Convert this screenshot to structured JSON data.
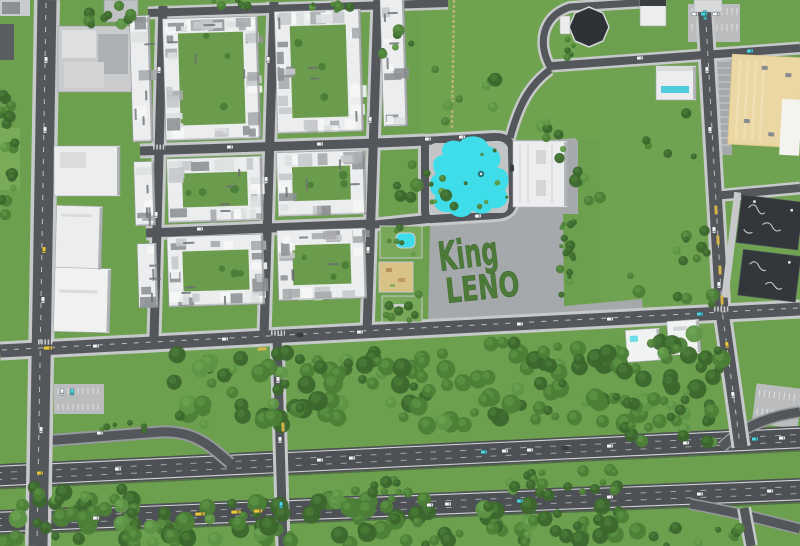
{
  "scene": {
    "description": "Top-down aerial view of a city district: residential apartment blocks, a cyan lagoon pool park, a concrete plaza with 'King LENO' written in hedges, green fields with tree belts, and a twin-carriageway highway with ramps along the bottom."
  },
  "plaza_sign": {
    "line1": "King",
    "line2": "LENO"
  },
  "palette": {
    "grass": "#6CA04E",
    "grass_light": "#7BAD5B",
    "tree_dark": "#3C672D",
    "tree_mid": "#4C7F37",
    "tree_light": "#5E9546",
    "asphalt": "#53565A",
    "highway": "#4D5054",
    "sidewalk": "#C6C8CA",
    "plaza": "#A6A9AC",
    "concrete_light": "#BABCBE",
    "pool": "#3EDDE9",
    "deck": "#C2C4C5",
    "white_bld": "#ECEDEE",
    "roof_gray": "#C9CBCC",
    "bld_shadow": "#7E8184",
    "beige": "#EBD7A4",
    "charcoal": "#33373B",
    "sand": "#D9C286",
    "hedge": "#4C7A38",
    "lane": "#E9EAEB",
    "dirt": "#C9B77A",
    "car_white": "#F4F5F6",
    "car_yellow": "#E9C83D",
    "car_cyan": "#4AD7E3",
    "car_dark": "#3A3E42",
    "park_green": "#79A85A"
  },
  "residential": {
    "blocks": [
      {
        "x": 167,
        "y": 16,
        "w": 95,
        "h": 122,
        "cy": true
      },
      {
        "x": 279,
        "y": 12,
        "w": 86,
        "h": 122,
        "cy": true
      },
      {
        "x": 385,
        "y": 2,
        "w": 24,
        "h": 128,
        "cy": false
      },
      {
        "x": 134,
        "y": 12,
        "w": 20,
        "h": 126,
        "cy": false
      },
      {
        "x": 167,
        "y": 156,
        "w": 95,
        "h": 64,
        "cy": true
      },
      {
        "x": 277,
        "y": 153,
        "w": 88,
        "h": 64,
        "cy": true
      },
      {
        "x": 134,
        "y": 158,
        "w": 20,
        "h": 64,
        "cy": false
      },
      {
        "x": 165,
        "y": 234,
        "w": 96,
        "h": 70,
        "cy": true
      },
      {
        "x": 275,
        "y": 231,
        "w": 88,
        "h": 70,
        "cy": true
      },
      {
        "x": 135,
        "y": 240,
        "w": 19,
        "h": 64,
        "cy": false
      }
    ]
  },
  "tree_clusters": [
    {
      "x": 165,
      "y": 352,
      "w": 300,
      "h": 74,
      "n": 95,
      "r0": 4,
      "r1": 10
    },
    {
      "x": 465,
      "y": 338,
      "w": 155,
      "h": 86,
      "n": 50,
      "r0": 4,
      "r1": 10
    },
    {
      "x": 622,
      "y": 332,
      "w": 100,
      "h": 92,
      "n": 40,
      "r0": 4,
      "r1": 10
    },
    {
      "x": 0,
      "y": 487,
      "w": 135,
      "h": 59,
      "n": 42,
      "r0": 4,
      "r1": 10
    },
    {
      "x": 130,
      "y": 498,
      "w": 300,
      "h": 48,
      "n": 65,
      "r0": 4,
      "r1": 10
    },
    {
      "x": 430,
      "y": 505,
      "w": 215,
      "h": 41,
      "n": 38,
      "r0": 4,
      "r1": 9
    },
    {
      "x": 648,
      "y": 528,
      "w": 120,
      "h": 18,
      "n": 10,
      "r0": 3,
      "r1": 6
    },
    {
      "x": 335,
      "y": 477,
      "w": 75,
      "h": 24,
      "n": 12,
      "r0": 3,
      "r1": 6
    },
    {
      "x": 505,
      "y": 468,
      "w": 115,
      "h": 30,
      "n": 20,
      "r0": 3,
      "r1": 6
    },
    {
      "x": 0,
      "y": 92,
      "w": 17,
      "h": 125,
      "n": 22,
      "r0": 3,
      "r1": 6
    },
    {
      "x": 88,
      "y": 0,
      "w": 48,
      "h": 26,
      "n": 12,
      "r0": 3,
      "r1": 6
    },
    {
      "x": 196,
      "y": 0,
      "w": 58,
      "h": 10,
      "n": 8,
      "r0": 2,
      "r1": 5
    },
    {
      "x": 306,
      "y": 0,
      "w": 46,
      "h": 10,
      "n": 7,
      "r0": 2,
      "r1": 5
    },
    {
      "x": 368,
      "y": 28,
      "w": 50,
      "h": 36,
      "n": 6,
      "r0": 3,
      "r1": 6
    },
    {
      "x": 432,
      "y": 60,
      "w": 78,
      "h": 66,
      "n": 8,
      "r0": 3,
      "r1": 7
    },
    {
      "x": 384,
      "y": 150,
      "w": 72,
      "h": 58,
      "n": 10,
      "r0": 3,
      "r1": 7
    },
    {
      "x": 532,
      "y": 96,
      "w": 40,
      "h": 42,
      "n": 5,
      "r0": 3,
      "r1": 6
    },
    {
      "x": 556,
      "y": 148,
      "w": 52,
      "h": 56,
      "n": 8,
      "r0": 3,
      "r1": 7
    },
    {
      "x": 560,
      "y": 213,
      "w": 14,
      "h": 92,
      "n": 16,
      "r0": 2,
      "r1": 5
    },
    {
      "x": 618,
      "y": 222,
      "w": 95,
      "h": 85,
      "n": 14,
      "r0": 3,
      "r1": 7
    },
    {
      "x": 640,
      "y": 102,
      "w": 58,
      "h": 55,
      "n": 5,
      "r0": 3,
      "r1": 6
    },
    {
      "x": 558,
      "y": 28,
      "w": 16,
      "h": 32,
      "n": 5,
      "r0": 2,
      "r1": 4
    },
    {
      "x": 428,
      "y": 143,
      "w": 84,
      "h": 68,
      "n": 10,
      "r0": 1.5,
      "r1": 3
    },
    {
      "x": 383,
      "y": 294,
      "w": 40,
      "h": 28,
      "n": 9,
      "r0": 2,
      "r1": 5
    },
    {
      "x": 386,
      "y": 226,
      "w": 38,
      "h": 30,
      "n": 6,
      "r0": 2,
      "r1": 4
    },
    {
      "x": 614,
      "y": 390,
      "w": 100,
      "h": 55,
      "n": 22,
      "r0": 3,
      "r1": 7
    },
    {
      "x": 95,
      "y": 415,
      "w": 50,
      "h": 20,
      "n": 6,
      "r0": 2,
      "r1": 5
    }
  ],
  "vehicles": [
    {
      "x": 118,
      "y": 469,
      "a": -2.7,
      "c": "w"
    },
    {
      "x": 320,
      "y": 460,
      "a": -2.7,
      "c": "w"
    },
    {
      "x": 40,
      "y": 473,
      "a": -2.7,
      "c": "y"
    },
    {
      "x": 352,
      "y": 458,
      "a": -2.7,
      "c": "w"
    },
    {
      "x": 484,
      "y": 452,
      "a": -2.7,
      "c": "c"
    },
    {
      "x": 505,
      "y": 451,
      "a": -2.7,
      "c": "w"
    },
    {
      "x": 530,
      "y": 450,
      "a": -2.7,
      "c": "w"
    },
    {
      "x": 565,
      "y": 448,
      "a": -2.7,
      "c": "d"
    },
    {
      "x": 610,
      "y": 446,
      "a": -2.7,
      "c": "w"
    },
    {
      "x": 686,
      "y": 443,
      "a": -2.7,
      "c": "w"
    },
    {
      "x": 755,
      "y": 439,
      "a": -2.7,
      "c": "c"
    },
    {
      "x": 782,
      "y": 438,
      "a": -2.7,
      "c": "w"
    },
    {
      "x": 96,
      "y": 518,
      "a": -2.3,
      "c": "w"
    },
    {
      "x": 200,
      "y": 514,
      "a": -2.3,
      "c": "y",
      "l": 10
    },
    {
      "x": 236,
      "y": 512,
      "a": -2.3,
      "c": "y",
      "l": 10
    },
    {
      "x": 258,
      "y": 511,
      "a": -2.3,
      "c": "y",
      "l": 9
    },
    {
      "x": 430,
      "y": 505,
      "a": -2.3,
      "c": "w"
    },
    {
      "x": 448,
      "y": 504,
      "a": -2.3,
      "c": "w"
    },
    {
      "x": 520,
      "y": 501,
      "a": -2.3,
      "c": "c"
    },
    {
      "x": 610,
      "y": 497,
      "a": -2.3,
      "c": "w"
    },
    {
      "x": 700,
      "y": 494,
      "a": -2.3,
      "c": "w"
    },
    {
      "x": 770,
      "y": 491,
      "a": -2.3,
      "c": "w"
    },
    {
      "x": 48,
      "y": 348,
      "a": -3,
      "c": "y",
      "l": 9
    },
    {
      "x": 96,
      "y": 346,
      "a": -3,
      "c": "w"
    },
    {
      "x": 225,
      "y": 339,
      "a": -3,
      "c": "w"
    },
    {
      "x": 300,
      "y": 335,
      "a": -3,
      "c": "d"
    },
    {
      "x": 360,
      "y": 332,
      "a": -3,
      "c": "w"
    },
    {
      "x": 520,
      "y": 324,
      "a": -3,
      "c": "w"
    },
    {
      "x": 610,
      "y": 319,
      "a": -3,
      "c": "w"
    },
    {
      "x": 700,
      "y": 314,
      "a": -3,
      "c": "c"
    },
    {
      "x": 46,
      "y": 60,
      "a": 91,
      "c": "w"
    },
    {
      "x": 45,
      "y": 130,
      "a": 91,
      "c": "w"
    },
    {
      "x": 44,
      "y": 250,
      "a": 91,
      "c": "y"
    },
    {
      "x": 43,
      "y": 300,
      "a": 91,
      "c": "w"
    },
    {
      "x": 41,
      "y": 430,
      "a": 91,
      "c": "w"
    },
    {
      "x": 705,
      "y": 15,
      "a": 87,
      "c": "c",
      "l": 9
    },
    {
      "x": 707,
      "y": 70,
      "a": 87,
      "c": "w"
    },
    {
      "x": 710,
      "y": 130,
      "a": 87,
      "c": "w"
    },
    {
      "x": 714,
      "y": 230,
      "a": 87,
      "c": "w"
    },
    {
      "x": 719,
      "y": 285,
      "a": 87,
      "c": "w"
    },
    {
      "x": 727,
      "y": 345,
      "a": 82,
      "c": "y"
    },
    {
      "x": 733,
      "y": 395,
      "a": 82,
      "c": "w"
    },
    {
      "x": 278,
      "y": 380,
      "a": 91,
      "c": "w"
    },
    {
      "x": 280,
      "y": 440,
      "a": 91,
      "c": "w"
    },
    {
      "x": 281,
      "y": 505,
      "a": 91,
      "c": "c"
    },
    {
      "x": 159,
      "y": 70,
      "a": 92,
      "c": "w"
    },
    {
      "x": 156,
      "y": 215,
      "a": 92,
      "c": "w"
    },
    {
      "x": 268,
      "y": 60,
      "a": 92,
      "c": "w"
    },
    {
      "x": 266,
      "y": 180,
      "a": 92,
      "c": "w"
    },
    {
      "x": 370,
      "y": 120,
      "a": 92,
      "c": "w"
    },
    {
      "x": 368,
      "y": 250,
      "a": 92,
      "c": "w"
    },
    {
      "x": 230,
      "y": 147,
      "a": -2,
      "c": "w"
    },
    {
      "x": 320,
      "y": 144,
      "a": -2,
      "c": "w"
    },
    {
      "x": 200,
      "y": 229,
      "a": -2,
      "c": "w"
    },
    {
      "x": 428,
      "y": 139,
      "a": -3,
      "c": "w"
    },
    {
      "x": 462,
      "y": 137,
      "a": -3,
      "c": "w"
    },
    {
      "x": 512,
      "y": 168,
      "a": 88,
      "c": "d"
    },
    {
      "x": 478,
      "y": 216,
      "a": -4,
      "c": "w"
    },
    {
      "x": 100,
      "y": 433,
      "a": -2,
      "c": "w"
    },
    {
      "x": 640,
      "y": 58,
      "a": -4,
      "c": "w"
    },
    {
      "x": 750,
      "y": 51,
      "a": -4,
      "c": "c"
    },
    {
      "x": 695,
      "y": 14,
      "a": 0,
      "c": "w"
    },
    {
      "x": 704,
      "y": 14,
      "a": 0,
      "c": "c"
    },
    {
      "x": 716,
      "y": 14,
      "a": 0,
      "c": "w"
    },
    {
      "x": 62,
      "y": 392,
      "a": 90,
      "c": "w"
    },
    {
      "x": 72,
      "y": 392,
      "a": 90,
      "c": "c"
    }
  ],
  "bus_stops": [
    {
      "x": 262,
      "y": 349,
      "a": -3
    },
    {
      "x": 283,
      "y": 427,
      "a": 88
    },
    {
      "x": 716,
      "y": 210,
      "a": 87
    },
    {
      "x": 718,
      "y": 240,
      "a": 87
    },
    {
      "x": 720,
      "y": 270,
      "a": 87
    },
    {
      "x": 722,
      "y": 300,
      "a": 87
    }
  ]
}
